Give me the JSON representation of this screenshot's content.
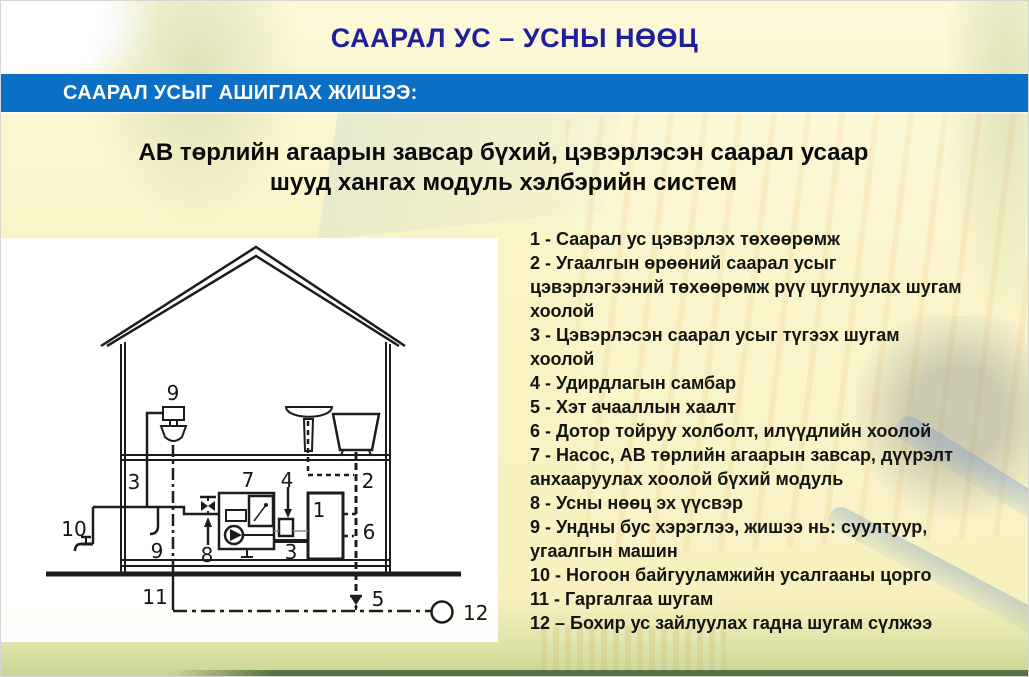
{
  "slide": {
    "title": "СААРАЛ УС – УСНЫ НӨӨЦ",
    "banner": "СААРАЛ УСЫГ АШИГЛАХ ЖИШЭЭ:",
    "heading": "АВ төрлийн агаарын завсар бүхий, цэвэрлэсэн саарал усаар\nшууд хангах модуль хэлбэрийн систем",
    "colors": {
      "banner_bg": "#0b6fc5",
      "title_color": "#1f1f9b",
      "background": "#faf4c6",
      "panel": "#ffffff",
      "ink": "#161616"
    }
  },
  "legend": {
    "items": [
      "1 - Саарал ус цэвэрлэх төхөөрөмж",
      "2 - Угаалгын өрөөний саарал усыг\nцэвэрлэгээний төхөөрөмж рүү цуглуулах шугам\nхоолой",
      "3 - Цэвэрлэсэн саарал усыг түгээх шугам\nхоолой",
      "4 - Удирдлагын самбар",
      "5 - Хэт ачааллын хаалт",
      "6 - Дотор тойруу холболт, илүүдлийн хоолой",
      "7 - Насос, АВ төрлийн агаарын завсар, дүүрэлт\nанхааруулах хоолой бүхий модуль",
      "8 - Усны нөөц эх үүсвэр",
      "9 - Ундны бус хэрэглээ, жишээ нь: суултуур,\nугаалгын машин",
      "10 - Ногоон байгууламжийн усалгааны цорго",
      "11 - Гаргалгаа шугам",
      "12 – Бохир ус зайлуулах гадна шугам сүлжээ"
    ]
  },
  "diagram": {
    "labels": {
      "tank": "1",
      "collector_pipe": "2",
      "distribution_upper": "3",
      "distribution_lower": "3",
      "control_panel": "4",
      "overload_valve": "5",
      "bypass": "6",
      "module": "7",
      "reserve_source": "8",
      "toilet": "9",
      "nonpotable_outlet": "9",
      "garden_tap": "10",
      "discharge_line": "11",
      "sewer_network": "12"
    }
  }
}
